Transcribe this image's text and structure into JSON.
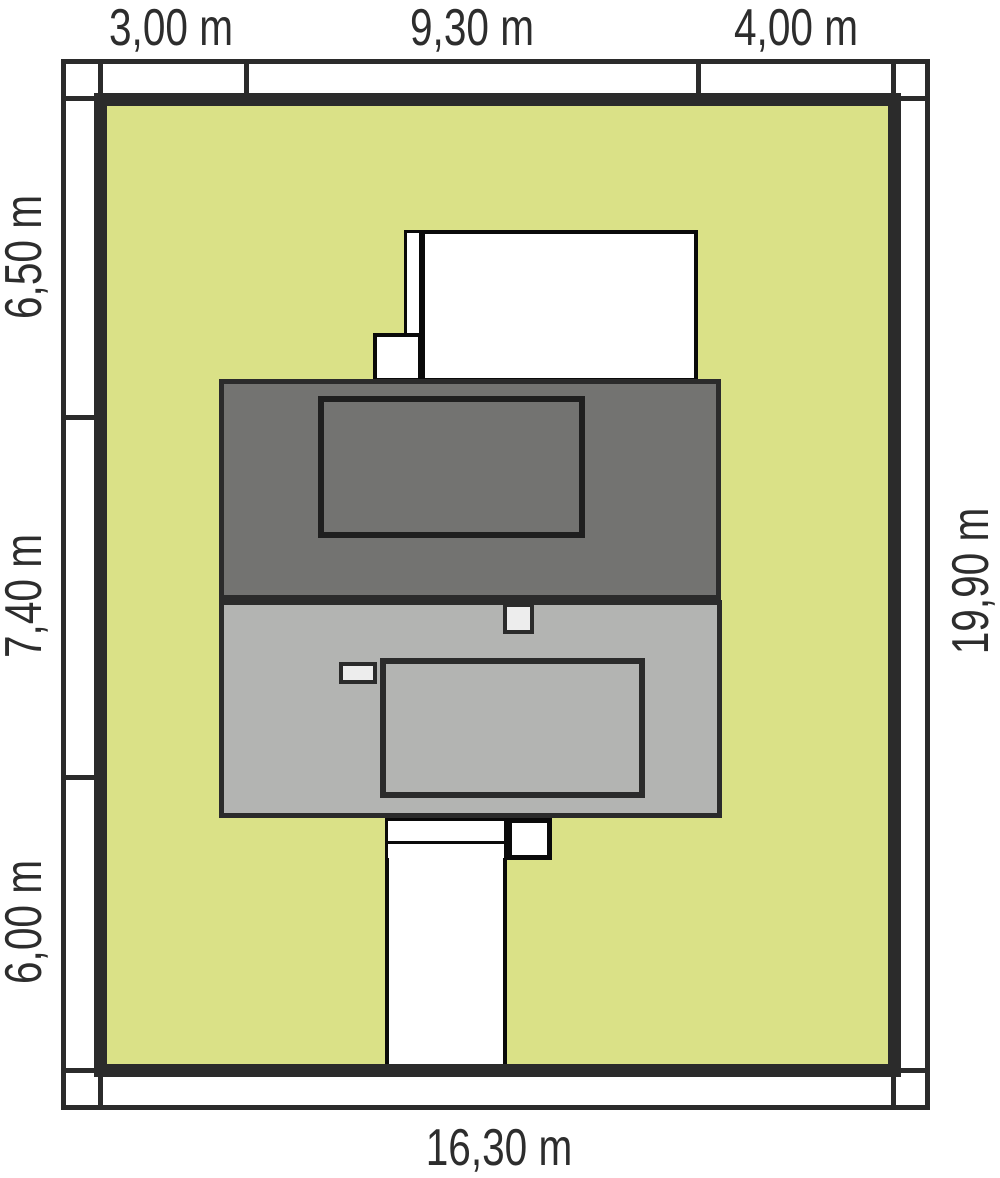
{
  "title": "House plot site plan",
  "colors": {
    "plot_green": "#dae187",
    "roof_dark": "#737371",
    "body_gray": "#b3b4b2",
    "vent_light": "#ededed",
    "line_dark": "#2b2b2b",
    "text": "#2d2d2d"
  },
  "dimensions": {
    "top": [
      "3,00 m",
      "9,30 m",
      "4,00 m"
    ],
    "left": [
      "6,50 m",
      "7,40 m",
      "6,00 m"
    ],
    "right": [
      "19,90 m"
    ],
    "bottom": [
      "16,30 m"
    ]
  }
}
